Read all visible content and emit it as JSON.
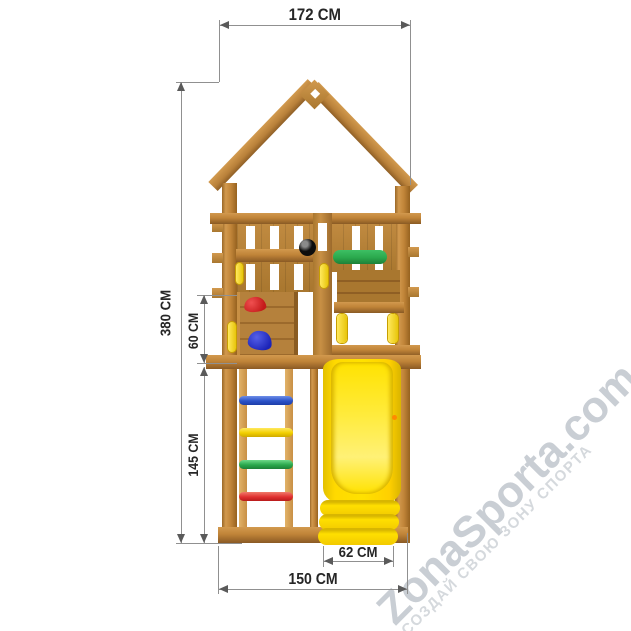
{
  "labels": {
    "top_width": "172 CM",
    "total_height": "380 CM",
    "wall_section_height": "60 CM",
    "ladder_section_height": "145 CM",
    "slide_width": "62 CM",
    "base_width": "150 CM"
  },
  "watermark": {
    "brand": "ZonaSporta.com",
    "slogan": "СОЗДАЙ СВОЮ ЗОНУ СПОРТА"
  },
  "components": {
    "structure": "wooden play tower with gable roof",
    "climbing_holds": [
      "red",
      "blue"
    ],
    "ladder_rung_colors_top_to_bottom": [
      "blue",
      "yellow",
      "green",
      "red"
    ],
    "grab_bar_color": "green",
    "handle_color": "yellow",
    "slide_color": "yellow"
  },
  "colors": {
    "wood": "#c08438",
    "wood_dark": "#8a5a24",
    "slide_yellow": "#ffe100",
    "accent_green": "#2aa84c",
    "accent_red": "#c41a1a",
    "accent_blue": "#1c24b8",
    "rung_blue": "#2b52c8",
    "rung_yellow": "#f2cf00",
    "rung_green": "#2aa84c",
    "rung_red": "#e03030",
    "handle_yellow": "#e8c50a",
    "dimension_line": "#909090",
    "dimension_text": "#262626",
    "watermark_gray": "#c9ced4",
    "watermark_gray_light": "#d5d9dd"
  }
}
